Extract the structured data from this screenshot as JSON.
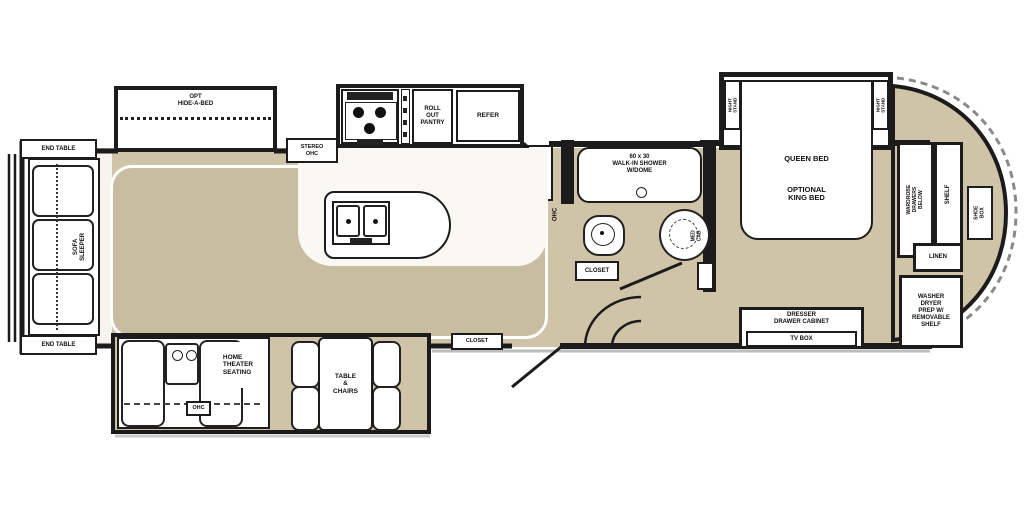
{
  "title": "RV fifth-wheel floor plan",
  "colors": {
    "floor": "#cfc4a8",
    "carpet": "#c9bda1",
    "wall": "#1c1c1c",
    "furniture": "#ffffff"
  },
  "labels": {
    "end_table_top": "END TABLE",
    "end_table_bottom": "END TABLE",
    "sofa_sleeper": "SOFA\nSLEEPER",
    "hide_a_bed": "OPT\nHIDE-A-BED",
    "stereo_ohc": "STEREO\nOHC",
    "roll_out_pantry": "ROLL\nOUT\nPANTRY",
    "refer": "REFER",
    "kitchen_ohc": "OHC",
    "shower": "60 x 30\nWALK-IN SHOWER\nW/DOME",
    "bath_closet": "CLOSET",
    "med_cab": "MED CAB",
    "entry_closet": "CLOSET",
    "queen_bed": "QUEEN BED",
    "optional_king_bed": "OPTIONAL\nKING BED",
    "night_stand_left": "NIGHT STAND",
    "night_stand_right": "NIGHT STAND",
    "wardrobe": "WARDROBE\nDRAWERS BELOW",
    "shelf": "SHELF",
    "shoe_box": "SHOE BOX",
    "linen": "LINEN",
    "washer_dryer": "WASHER\nDRYER\nPREP W/\nREMOVABLE\nSHELF",
    "dresser": "DRESSER\nDRAWER CABINET",
    "tv_box": "TV BOX",
    "home_theater": "HOME\nTHEATER\nSEATING",
    "theater_ohc": "OHC",
    "table_chairs": "TABLE\n&\nCHAIRS"
  }
}
